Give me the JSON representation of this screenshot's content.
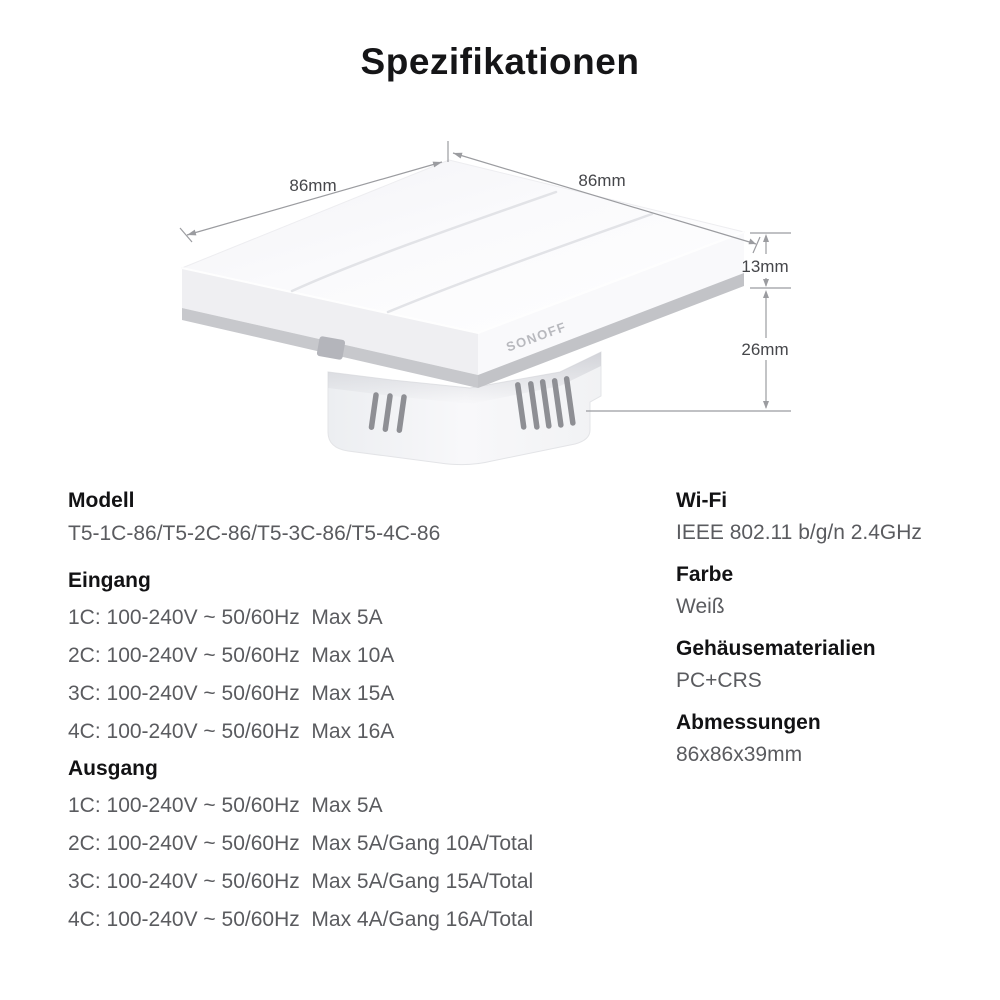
{
  "page": {
    "title": "Spezifikationen"
  },
  "product_diagram": {
    "brand_logo": "SONOFF",
    "dimension_labels": {
      "top_left_width": "86mm",
      "top_right_width": "86mm",
      "panel_thickness": "13mm",
      "box_depth": "26mm"
    }
  },
  "specs": {
    "left_column": [
      {
        "label": "Modell",
        "lines": [
          "T5-1C-86/T5-2C-86/T5-3C-86/T5-4C-86"
        ]
      },
      {
        "label": "Eingang",
        "lines": [
          "1C: 100-240V ~ 50/60Hz  Max 5A",
          "2C: 100-240V ~ 50/60Hz  Max 10A",
          "3C: 100-240V ~ 50/60Hz  Max 15A",
          "4C: 100-240V ~ 50/60Hz  Max 16A"
        ]
      },
      {
        "label": "Ausgang",
        "lines": [
          "1C: 100-240V ~ 50/60Hz  Max 5A",
          "2C: 100-240V ~ 50/60Hz  Max 5A/Gang 10A/Total",
          "3C: 100-240V ~ 50/60Hz  Max 5A/Gang 15A/Total",
          "4C: 100-240V ~ 50/60Hz  Max 4A/Gang 16A/Total"
        ]
      }
    ],
    "right_column": [
      {
        "label": "Wi-Fi",
        "lines": [
          "IEEE 802.11 b/g/n 2.4GHz"
        ]
      },
      {
        "label": "Farbe",
        "lines": [
          "Weiß"
        ]
      },
      {
        "label": "Gehäusematerialien",
        "lines": [
          "PC+CRS"
        ]
      },
      {
        "label": "Abmessungen",
        "lines": [
          "86x86x39mm"
        ]
      }
    ]
  },
  "colors": {
    "heading_text": "#121214",
    "body_text": "#5a5b5f",
    "dimension_text": "#45464a",
    "dimension_line": "#9b9ca0",
    "device_gray_band": "#c7c8cc",
    "background": "#ffffff"
  }
}
